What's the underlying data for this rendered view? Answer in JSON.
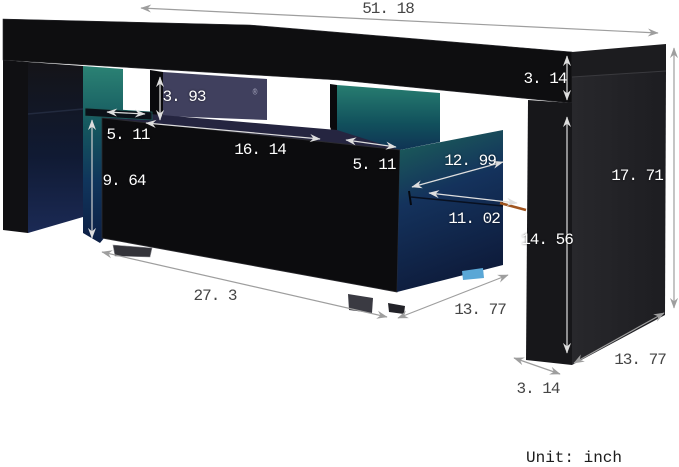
{
  "annotations": {
    "unit_note": "Unit: inch",
    "registered_symbol": "®"
  },
  "dimensions": {
    "top_length": "51. 18",
    "top_thickness": "3. 14",
    "shelf_opening_height": "3. 93",
    "left_shelf_depth": "5. 11",
    "middle_opening_width": "16. 14",
    "right_opening_width": "5. 11",
    "cabinet_side_diagonal": "12. 99",
    "drawer_width": "11. 02",
    "cabinet_height": "9. 64",
    "side_inner_height": "14. 56",
    "overall_height": "17. 71",
    "cabinet_width": "27. 3",
    "cabinet_depth": "13. 77",
    "panel_depth": "13. 77",
    "panel_thickness": "3. 14"
  },
  "colors": {
    "panel_black": "#0e0e10",
    "led_teal": "#2b8274",
    "back_navy": "#40405e",
    "cabinet_blue": "#14325c",
    "foot_blue": "#5aa7d6",
    "accent_orange": "#a0541e",
    "arrow_gray": "#9e9e9e",
    "arrow_light": "#dedede",
    "label_dark": "#454545",
    "label_light": "#ffffff"
  }
}
